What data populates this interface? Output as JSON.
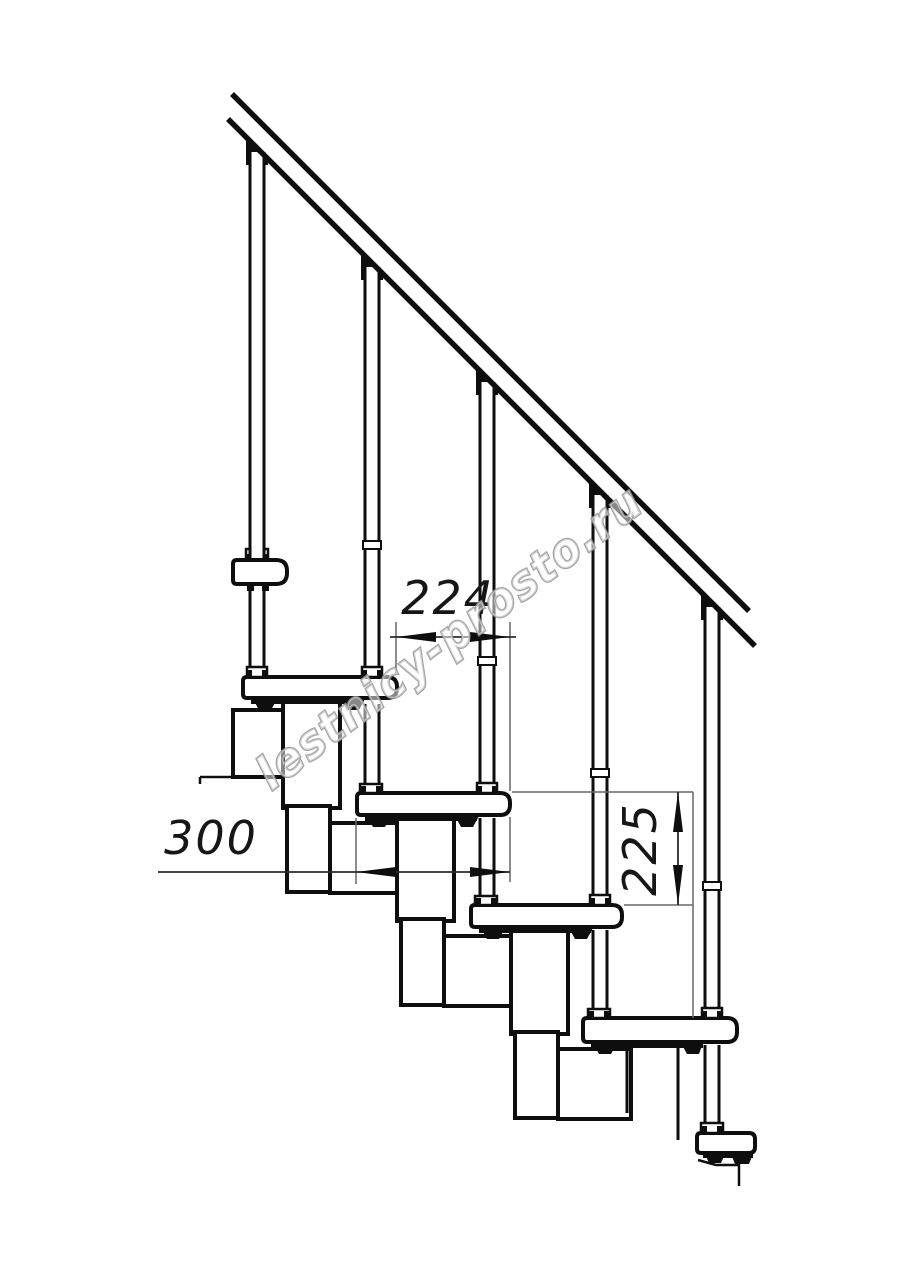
{
  "page": {
    "width": 914,
    "height": 1280,
    "background": "#ffffff",
    "description": "Technical side-elevation line drawing of a modular staircase with handrail, balusters, treads, support modules and three dimension callouts"
  },
  "dimensions": {
    "step_run": {
      "value": "224",
      "orientation": "horizontal",
      "measures": "horizontal offset between tread noses"
    },
    "step_depth": {
      "value": "300",
      "orientation": "horizontal",
      "measures": "tread depth"
    },
    "step_rise": {
      "value": "225",
      "orientation": "vertical",
      "measures": "rise between tread tops"
    }
  },
  "watermark": {
    "text": "lestnicy-prosto.ru"
  },
  "colors": {
    "ink": "#0e0e0e",
    "dimension_line": "#2b2b2b",
    "extension_line": "#666666",
    "dimension_text": "#161616",
    "watermark_outline": "#949494",
    "background": "#ffffff"
  }
}
